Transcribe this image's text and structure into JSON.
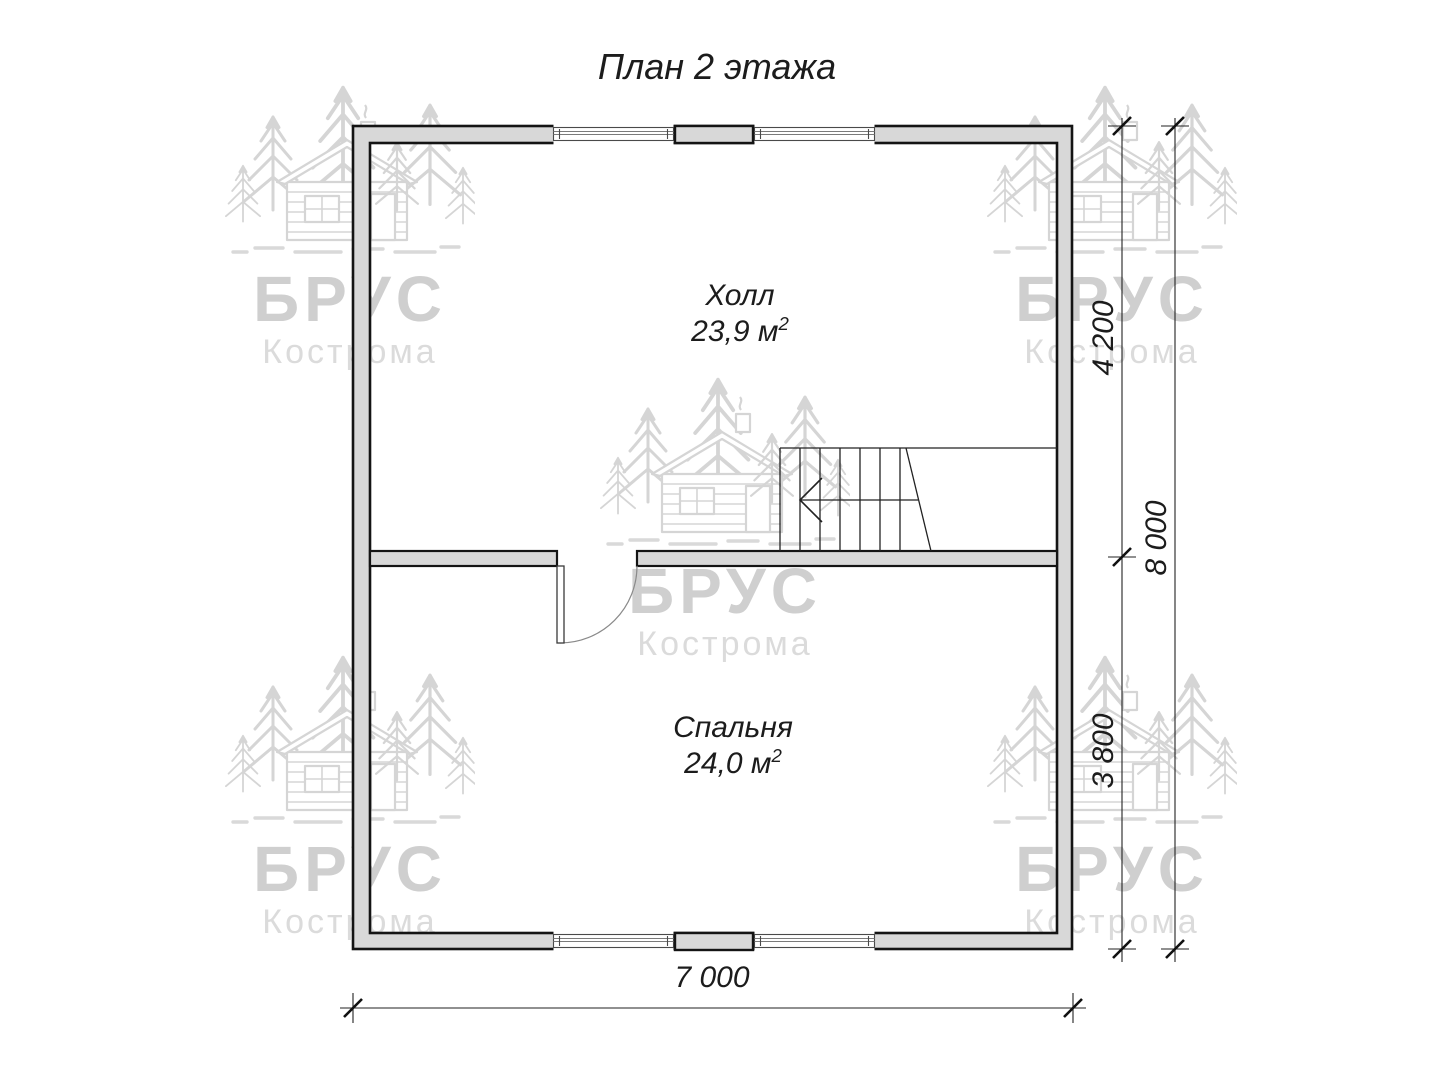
{
  "title": "План 2 этажа",
  "rooms": [
    {
      "name": "Холл",
      "area": "23,9 м",
      "area_sup": "2"
    },
    {
      "name": "Спальня",
      "area": "24,0 м",
      "area_sup": "2"
    }
  ],
  "dimensions": {
    "hall_depth": "4 200",
    "bedroom_depth": "3 800",
    "total_depth": "8 000",
    "total_width": "7 000"
  },
  "watermark": {
    "brand": "БРУС",
    "city": "Кострома"
  },
  "colors": {
    "wall_fill": "#d8d8d8",
    "line": "#141414",
    "watermark": "#d5d5d5"
  }
}
